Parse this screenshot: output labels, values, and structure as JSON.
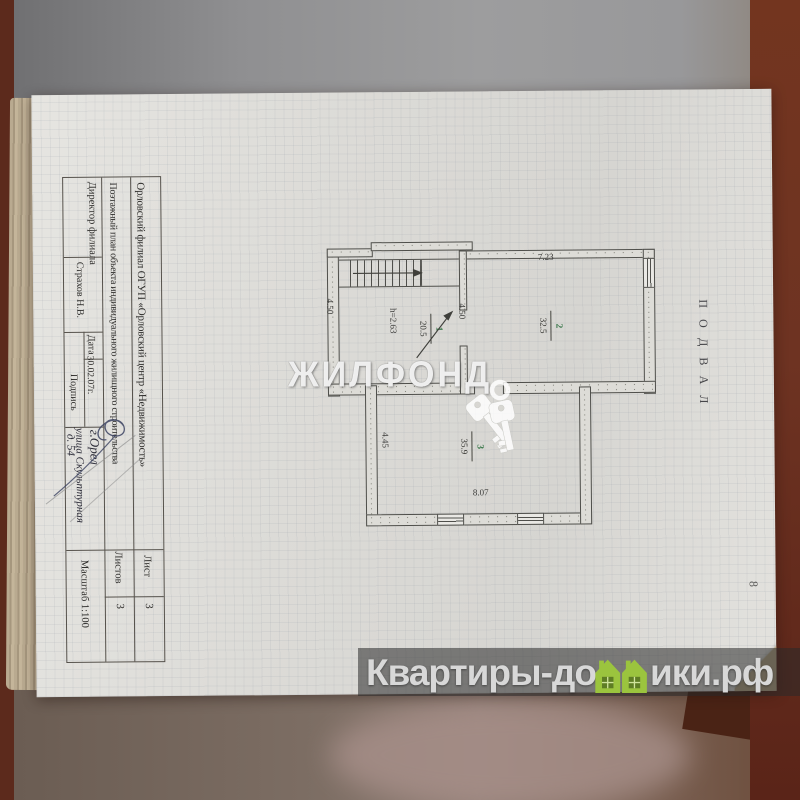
{
  "title_block": {
    "org": "Орловский филиал ОГУП «Орловский центр «Недвижимость»",
    "doc": "Поэтажный план объекта индивидуального жилищного строительства",
    "director_label": "Директор филиала",
    "director_name": "Страхов Н.В.",
    "date_label": "Дата",
    "date_value": "30.02.07г.",
    "sign_label": "Подпись",
    "address_city": "г.Орел",
    "address_street": "улица Скульптурная",
    "address_house": "д. 54",
    "sheet_label": "Лист",
    "sheet_value": "3",
    "sheets_label": "Листов",
    "sheets_value": "3",
    "scale_label": "Масштаб 1:100"
  },
  "plan": {
    "floor_label": "ПОДВАЛ",
    "page_number": "8",
    "rooms": [
      {
        "number": "1",
        "area": "20.5",
        "height": "h=2.63"
      },
      {
        "number": "2",
        "area": "32.5"
      },
      {
        "number": "3",
        "area": "35.9"
      }
    ],
    "dimensions": {
      "room1_left": "4.50",
      "room2_left": "4.50",
      "room2_top": "7.23",
      "room3_left": "4.45",
      "room3_bottom": "8.07"
    },
    "room_number_color": "#3e7a4e"
  },
  "watermarks": {
    "center_text": "ЖИЛФОНД",
    "logo_prefix": "Квартиры-до",
    "logo_suffix": "ики.рф",
    "logo_house_color": "#9bc43e",
    "logo_house_dark": "#5e7d24"
  }
}
